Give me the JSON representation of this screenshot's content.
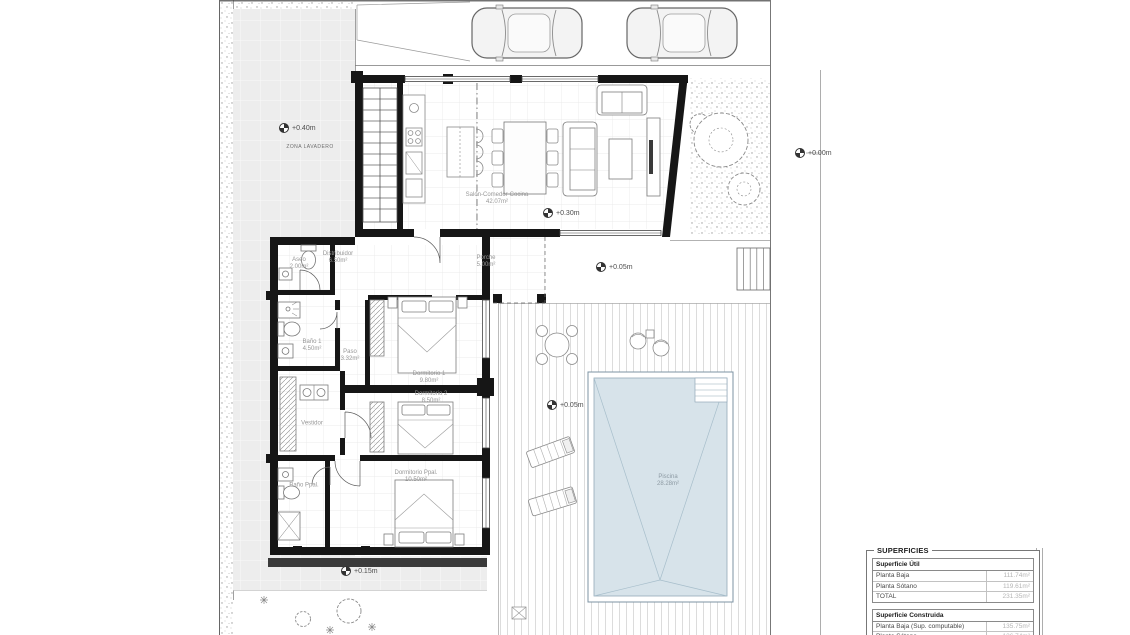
{
  "plan": {
    "rooms": [
      {
        "name": "Salón-Comedor-Cocina",
        "area": "42.07m²"
      },
      {
        "name": "Distribuidor",
        "area": "6.50m²"
      },
      {
        "name": "Aseo",
        "area": "2.00m²"
      },
      {
        "name": "Porche",
        "area": "5.00m²"
      },
      {
        "name": "Baño 1",
        "area": "4.50m²"
      },
      {
        "name": "Paso",
        "area": "3.32m²"
      },
      {
        "name": "Dormitorio 1",
        "area": "9.80m²"
      },
      {
        "name": "Dormitorio 2",
        "area": "8.50m²"
      },
      {
        "name": "Vestidor",
        "area": ""
      },
      {
        "name": "Baño Ppal.",
        "area": ""
      },
      {
        "name": "Dormitorio Ppal.",
        "area": "10.50m²"
      },
      {
        "name": "Piscina",
        "area": "28.28m²"
      }
    ],
    "levels": [
      {
        "label": "+0.40m"
      },
      {
        "label": "+0.30m"
      },
      {
        "label": "+0.05m"
      },
      {
        "label": "+0.05m"
      },
      {
        "label": "+0.15m"
      },
      {
        "label": "+0.00m"
      }
    ],
    "annotations": {
      "laundry_zone": "ZONA LAVADERO"
    }
  },
  "superficies": {
    "title": "SUPERFICIES",
    "util": {
      "header": "Superficie Útil",
      "rows": [
        {
          "label": "Planta Baja",
          "value": "111.74m²"
        },
        {
          "label": "Planta Sótano",
          "value": "119.61m²"
        },
        {
          "label": "TOTAL",
          "value": "231.35m²"
        }
      ]
    },
    "construida": {
      "header": "Superficie Construida",
      "rows": [
        {
          "label": "Planta Baja (Sup. computable)",
          "value": "135.75m²"
        },
        {
          "label": "Planta Sótano",
          "value": "136.74m²"
        }
      ]
    }
  },
  "colors": {
    "wall": "#161616",
    "pool_water": "#d7e3ea",
    "paving_gray": "#ededed",
    "label_gray": "#979797"
  }
}
